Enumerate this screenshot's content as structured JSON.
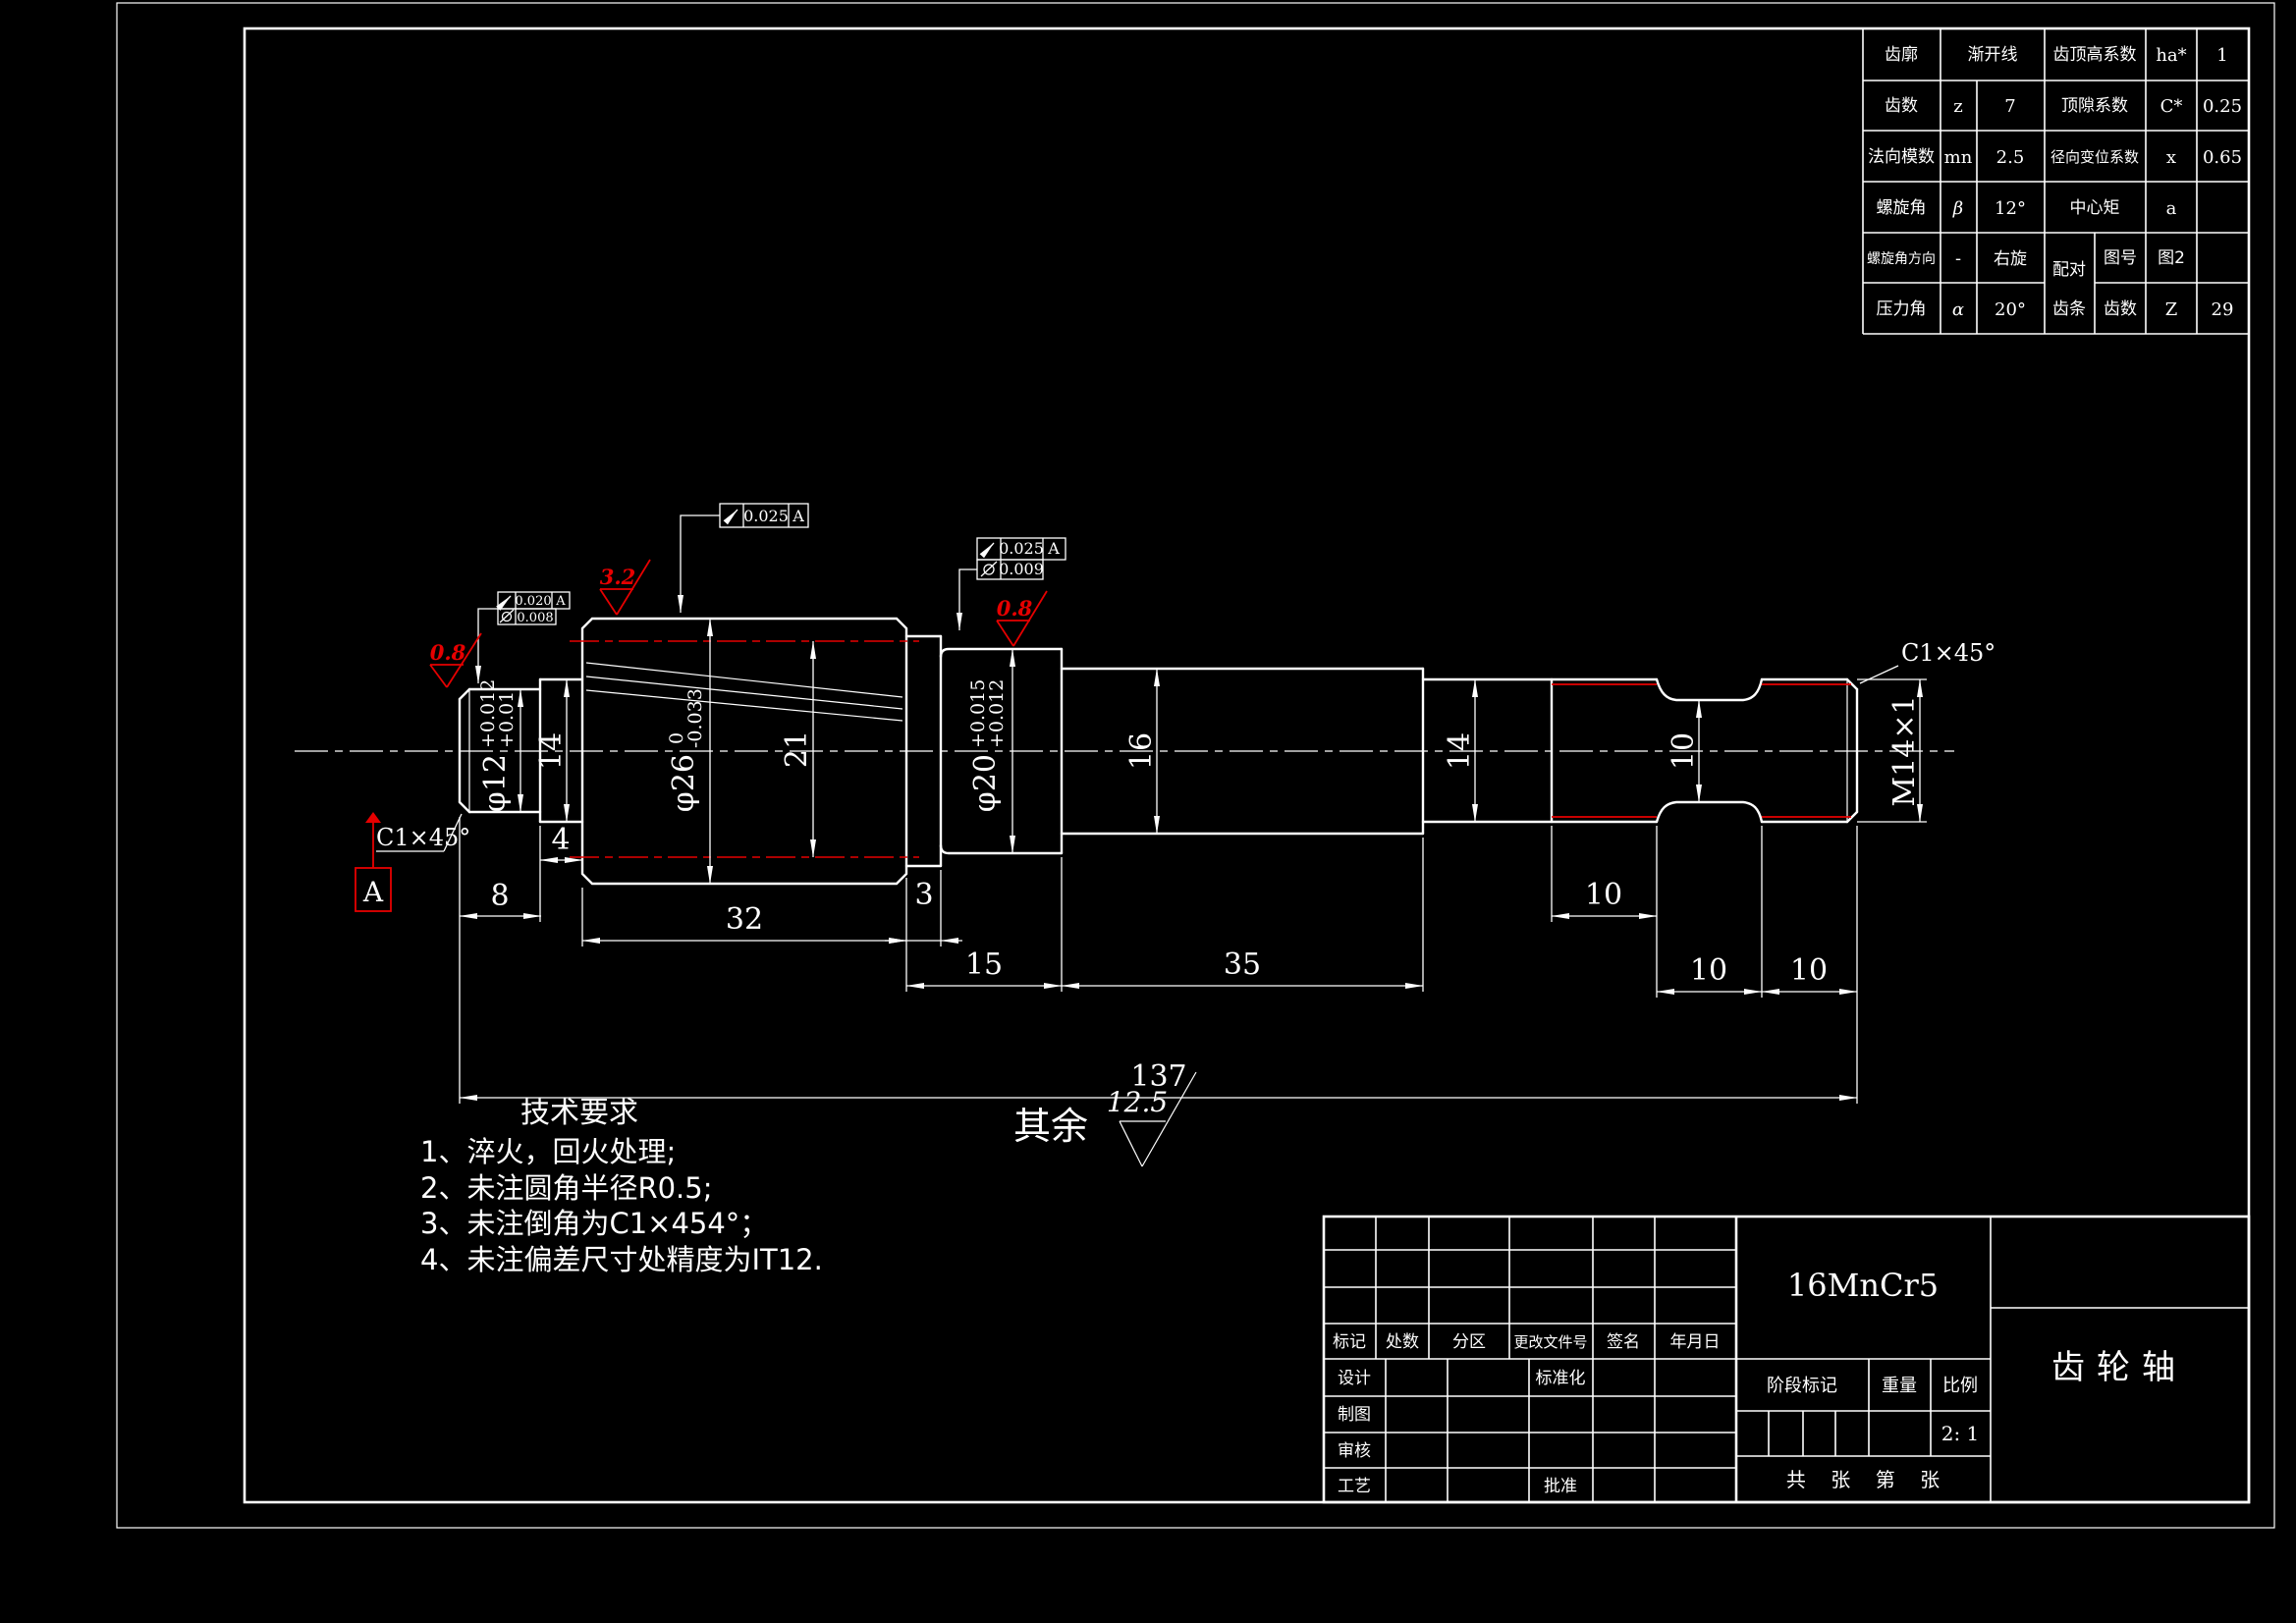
{
  "colors": {
    "bg": "#000000",
    "line": "#ffffff",
    "accent_red": "#e60000"
  },
  "gear_table": {
    "profile_label": "齿廓",
    "profile_value": "渐开线",
    "addendum_label": "齿顶高系数",
    "addendum_sym": "ha*",
    "addendum_val": "1",
    "teeth_label": "齿数",
    "teeth_sym": "z",
    "teeth_val": "7",
    "clearance_label": "顶隙系数",
    "clearance_sym": "C*",
    "clearance_val": "0.25",
    "module_label": "法向模数",
    "module_sym": "mn",
    "module_val": "2.5",
    "shift_label": "径向变位系数",
    "shift_sym": "x",
    "shift_val": "0.65",
    "helix_label": "螺旋角",
    "helix_sym": "β",
    "helix_val": "12°",
    "center_label": "中心矩",
    "center_sym": "a",
    "helix_dir_label": "螺旋角方向",
    "helix_dir_sym": "-",
    "helix_dir_val": "右旋",
    "mate_label_1": "配对",
    "mate_label_2": "齿条",
    "fig_label": "图号",
    "fig_val": "图2",
    "pressure_label": "压力角",
    "pressure_sym": "α",
    "pressure_val": "20°",
    "mate_teeth_label": "齿数",
    "mate_teeth_sym": "Z",
    "mate_teeth_val": "29"
  },
  "dims": {
    "d8": "8",
    "d4": "4",
    "d32": "32",
    "d3": "3",
    "d15": "15",
    "d35": "35",
    "d10a": "10",
    "d10b": "10",
    "d10c": "10",
    "d137": "137",
    "d14_left": "14",
    "d21": "21",
    "d16": "16",
    "d14_right": "14",
    "d10_neck": "10",
    "thread": "M14×1",
    "dia12": {
      "base": "φ12",
      "upper": "+0.012",
      "lower": "+0.01"
    },
    "dia26": {
      "base": "φ26",
      "upper": "0",
      "lower": "-0.033"
    },
    "dia20": {
      "base": "φ20",
      "upper": "+0.015",
      "lower": "+0.012"
    }
  },
  "gtol": {
    "top": {
      "value": "0.025",
      "datum": "A"
    },
    "left": {
      "r1_value": "0.020",
      "r1_datum": "A",
      "r2_value": "0.008"
    },
    "mid": {
      "r1_value": "0.025",
      "r1_datum": "A",
      "r2_value": "0.009"
    }
  },
  "rough": {
    "left": "0.8",
    "gear": "3.2",
    "mid": "0.8",
    "rest_label": "其余",
    "rest_value": "12.5"
  },
  "datum_label": "A",
  "chamfer_left": "C1×45°",
  "chamfer_right": "C1×45°",
  "tech": {
    "title": "技术要求",
    "line1": "1、淬火，回火处理;",
    "line2": "2、未注圆角半径R0.5;",
    "line3": "3、未注倒角为C1×454°；",
    "line4": "4、未注偏差尺寸处精度为IT12."
  },
  "tb": {
    "mark": "标记",
    "count": "处数",
    "zone": "分区",
    "doc_no": "更改文件号",
    "sign": "签名",
    "date": "年月日",
    "design": "设计",
    "draft": "制图",
    "check": "审核",
    "process": "工艺",
    "standard": "标准化",
    "approve": "批准",
    "material": "16MnCr5",
    "stage_label": "阶段标记",
    "weight_label": "重量",
    "scale_label": "比例",
    "scale_value": "2: 1",
    "sheet_info": "共    张    第    张",
    "part_name": "齿轮轴"
  }
}
